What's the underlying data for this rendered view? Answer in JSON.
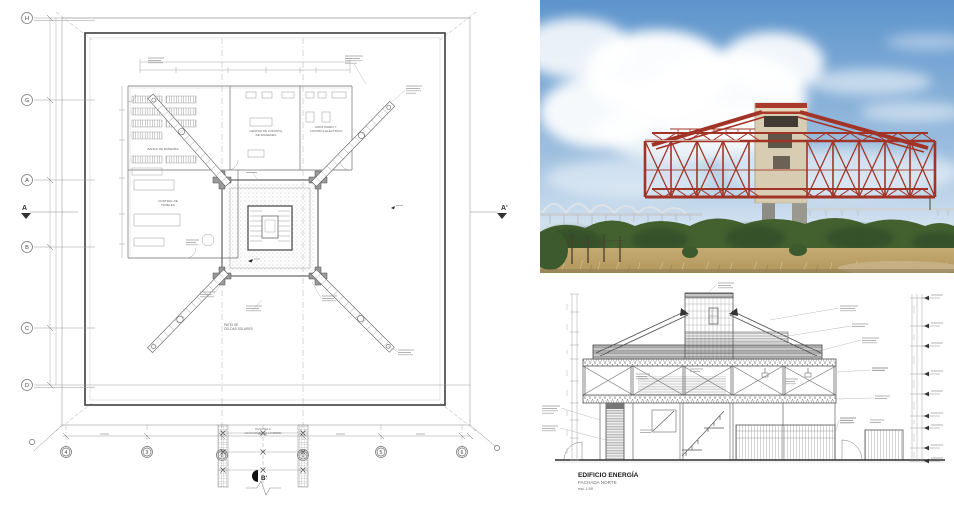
{
  "plan": {
    "grid_rows": [
      "H",
      "G",
      "A",
      "B",
      "C",
      "D"
    ],
    "grid_cols": [
      "4",
      "3",
      "2",
      "1",
      "5",
      "6"
    ],
    "section_left": "A",
    "section_right": "A'",
    "section_bottom": "B'",
    "labels": {
      "banco": "BANCO DE BATERÍAS",
      "centro_1": "CENTRO DE CONTROL",
      "centro_2": "DE  IMÁGENES",
      "monitoreo_1": "MONITOREO Y",
      "monitoreo_2": "CONTROL ELÉCTRICO",
      "paneles_1": "CONTROL DE",
      "paneles_2": "PANELES",
      "patio_1": "PATIO DE",
      "patio_2": "CELDAS SOLARES",
      "pasarela_1": "PASARELA",
      "pasarela_2": "HACIA EDIFICIO HOMBRE"
    }
  },
  "photo": {
    "description": "Edificio Energía: red steel truss box on concrete pylons, General Rafael Urdaneta bridge behind, scrubland foreground",
    "colors": {
      "truss_red": "#a23427",
      "sky_top": "#5d94cc",
      "sky_bottom": "#d6e4f1",
      "tower_cream": "#d8cdb2",
      "bush_green": "#42612f",
      "grass_tan": "#bfa56b"
    }
  },
  "elevation": {
    "title": "EDIFICIO ENERGÍA",
    "subtitle": "FACHADA NORTE",
    "scale": "esc 1:50"
  }
}
